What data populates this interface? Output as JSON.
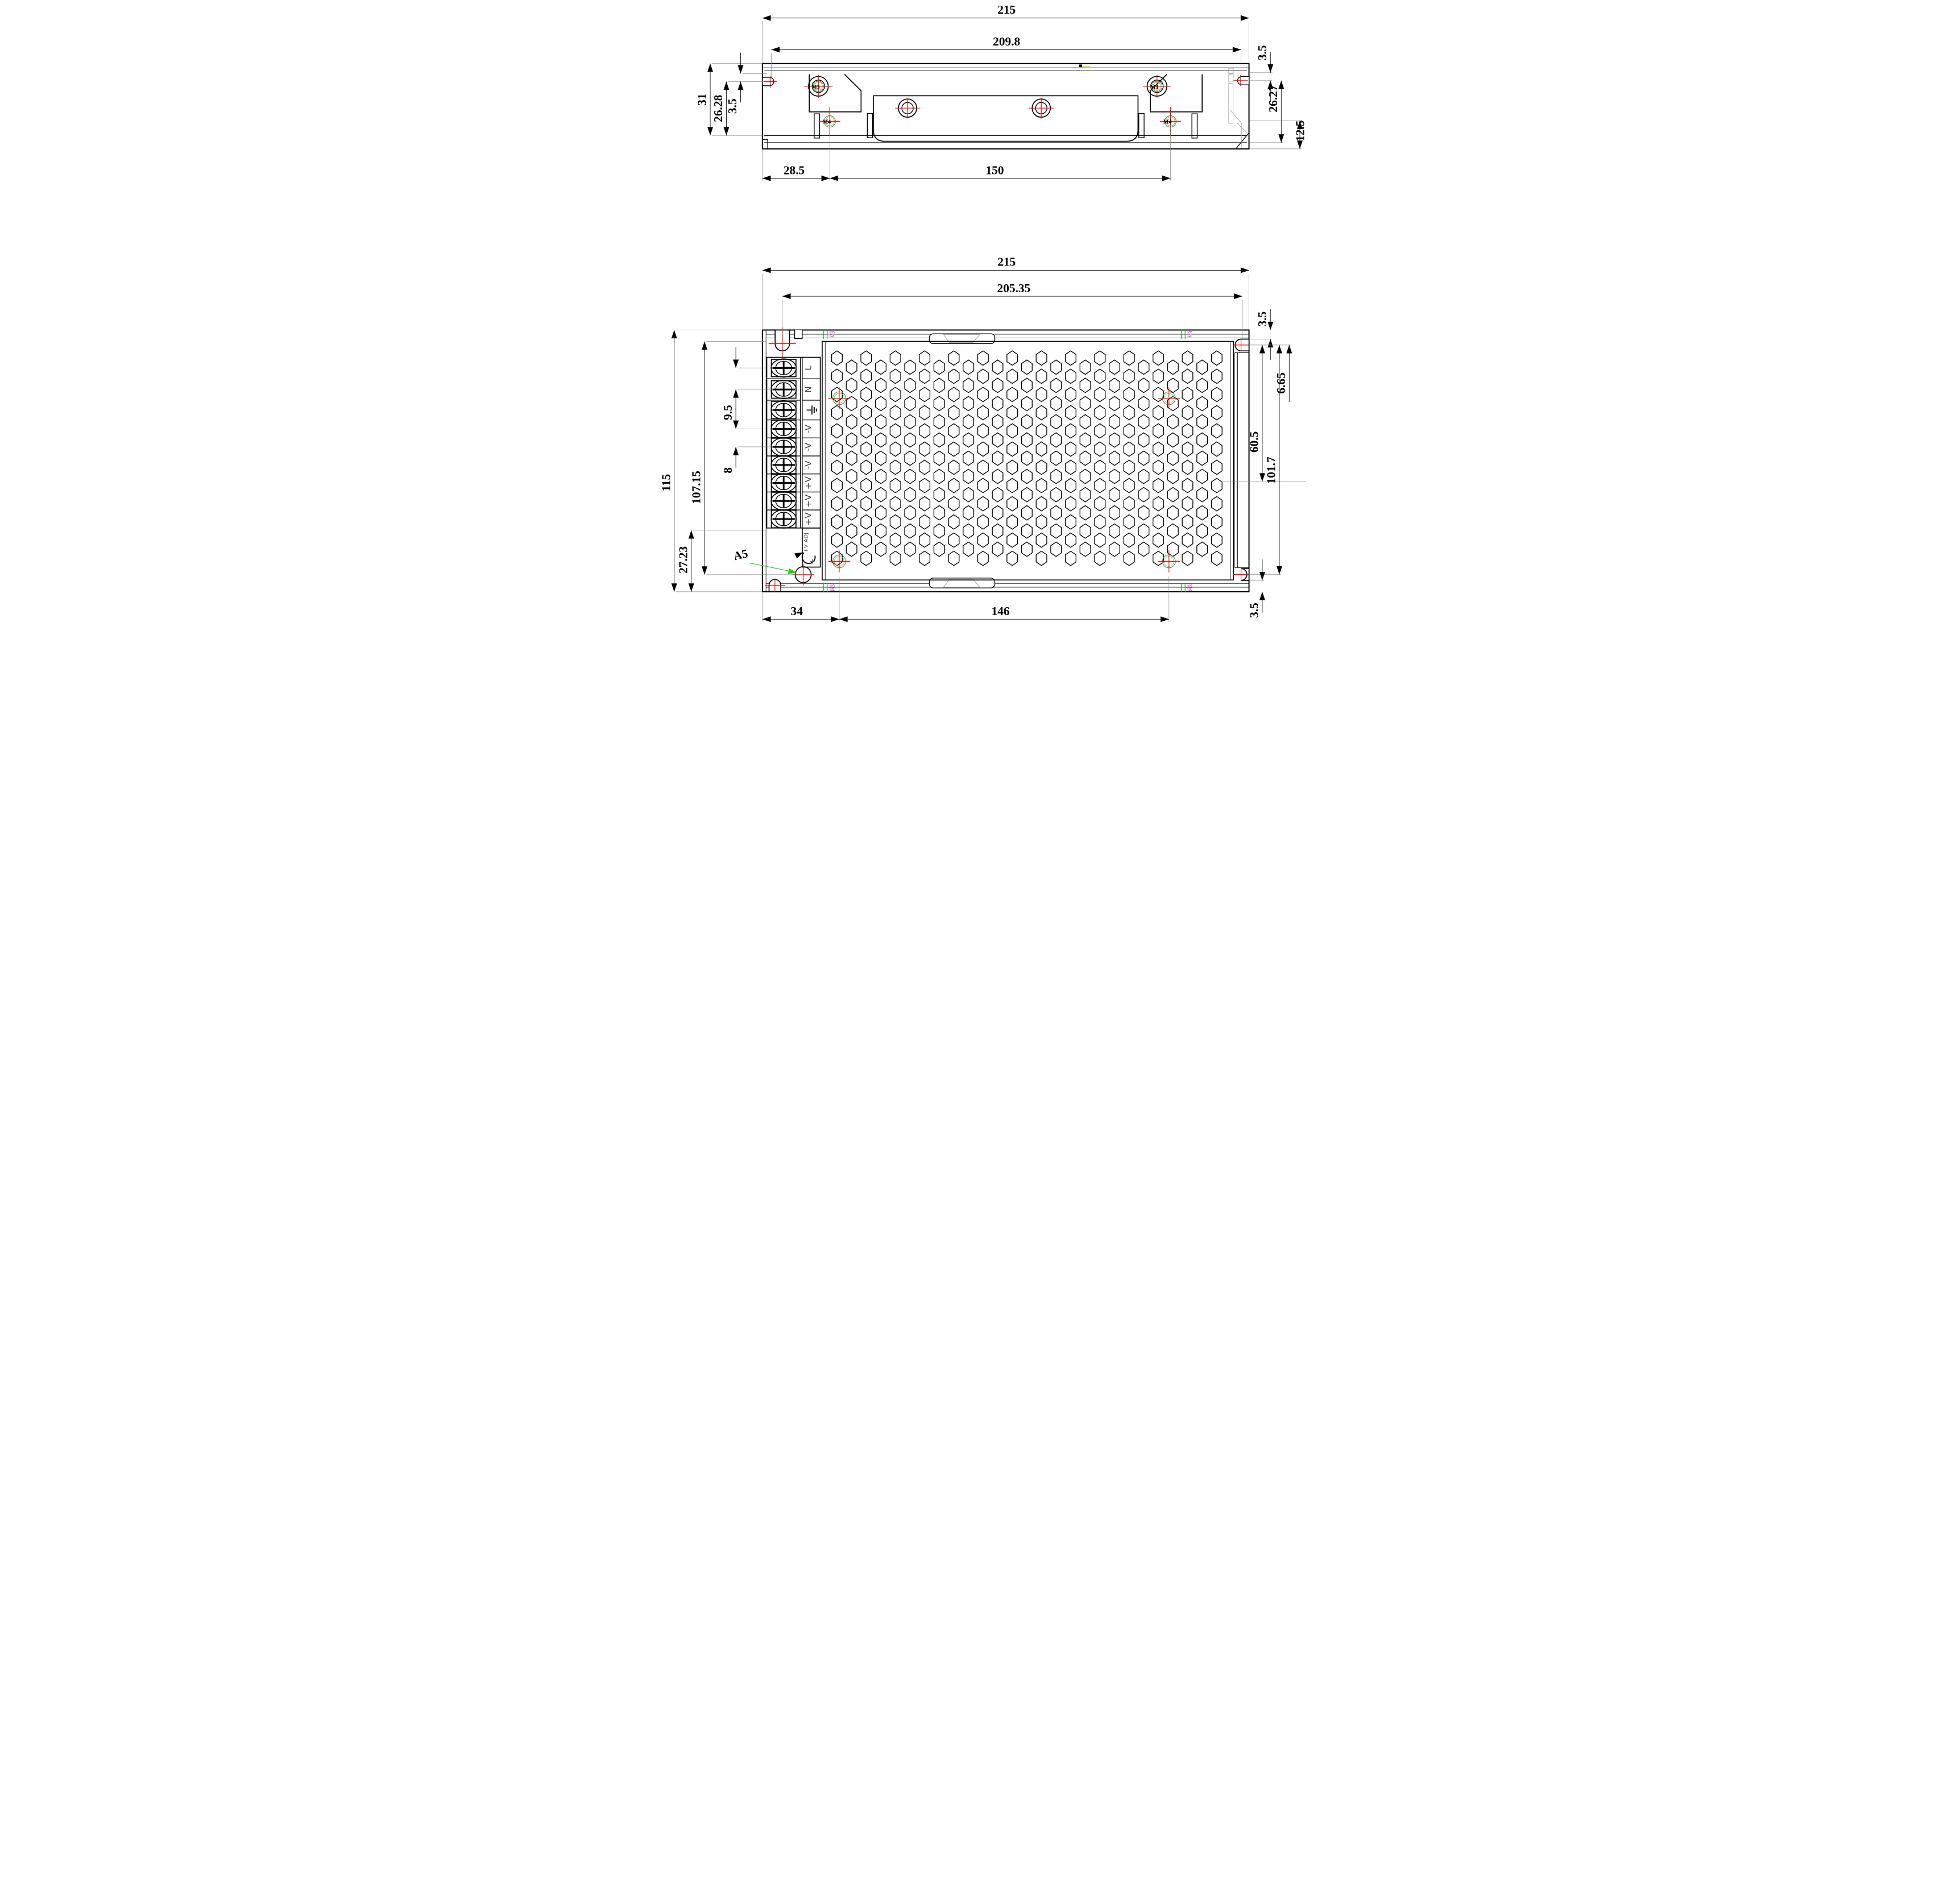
{
  "title": "Power supply enclosure dimensional drawing",
  "top_view": {
    "dims": {
      "overall_width": "215",
      "slot_span": "209.8",
      "right_top_offset": "3.5",
      "overall_height": "31",
      "height_inner": "26.28",
      "left_slot_offset": "3.5",
      "right_height": "26.27",
      "base_height": "12.5",
      "hole_left_offset": "28.5",
      "hole_spacing": "150"
    },
    "labels": {
      "m3": "M3",
      "m4": "M4"
    }
  },
  "bottom_view": {
    "dims": {
      "overall_width": "215",
      "slot_span": "205.35",
      "right_top_offset": "3.5",
      "right_slot_offset": "6.65",
      "rail_center": "60.5",
      "slot_vertical_span": "101.7",
      "right_bottom_offset": "3.5",
      "overall_height": "115",
      "inner_height": "107.15",
      "terminal_pitch_input": "9.5",
      "terminal_pitch_output": "8",
      "bottom_left_height": "27.23",
      "hole_left_offset": "34",
      "hole_spacing": "146"
    },
    "labels": {
      "hole_a5": "A5",
      "tick_m3": "M3"
    },
    "terminals": [
      {
        "label": "L"
      },
      {
        "label": "N"
      },
      {
        "label": "⏚",
        "icon": "earth-ground"
      },
      {
        "label": "-V"
      },
      {
        "label": "-V"
      },
      {
        "label": "-V"
      },
      {
        "label": "+V"
      },
      {
        "label": "+V"
      },
      {
        "label": "+V"
      }
    ],
    "adjuster": {
      "label": "+V ADJ",
      "plus": "+"
    }
  },
  "colors": {
    "outline": "#000000",
    "ext": "#808080",
    "centerline_red": "#ff0000",
    "hole_green": "#00aa22",
    "hole_tan": "#cc9977",
    "label_magenta": "#cc44cc",
    "leader_green": "#22cc22",
    "hidden_gray": "#999999",
    "tick_yellow": "#dddd00"
  }
}
